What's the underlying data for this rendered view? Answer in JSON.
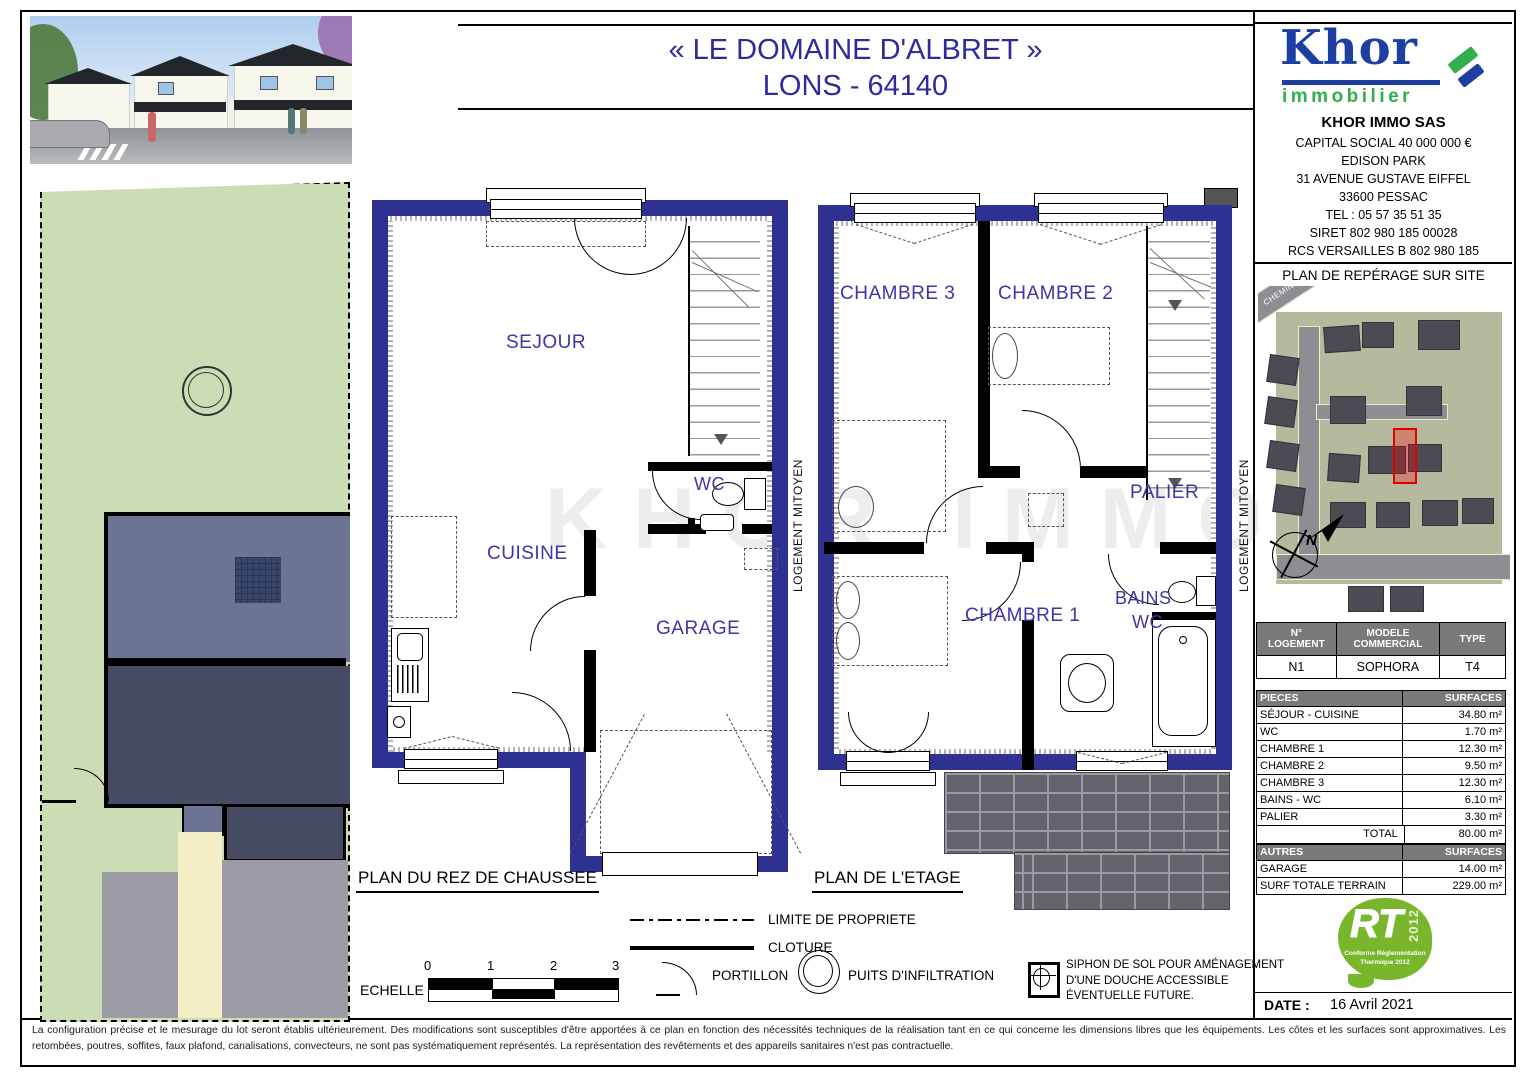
{
  "title": {
    "line1": "« LE DOMAINE D'ALBRET »",
    "line2": "LONS - 64140"
  },
  "logo": {
    "main": "Khor",
    "sub": "immobilier"
  },
  "company": {
    "name": "KHOR IMMO SAS",
    "line1": "CAPITAL SOCIAL 40 000 000 €",
    "line2": "EDISON PARK",
    "line3": "31 AVENUE GUSTAVE EIFFEL",
    "line4": "33600 PESSAC",
    "line5": "TEL : 05 57 35 51 35",
    "line6": "SIRET 802 980 185 00028",
    "line7": "RCS VERSAILLES B 802 980 185"
  },
  "site_map": {
    "title": "PLAN DE REPÉRAGE SUR SITE",
    "road_label": "CHEMIN DE LASGOURGES",
    "north_label": "N"
  },
  "plans": {
    "rdc_title": "PLAN DU REZ DE CHAUSSEE",
    "etage_title": "PLAN DE L'ETAGE",
    "party_wall": "LOGEMENT MITOYEN",
    "rooms": {
      "sejour": "SEJOUR",
      "wc": "WC",
      "cuisine": "CUISINE",
      "garage": "GARAGE",
      "ch3": "CHAMBRE 3",
      "ch2": "CHAMBRE 2",
      "palier": "PALIER",
      "ch1": "CHAMBRE 1",
      "bains1": "BAINS",
      "bains2": "WC"
    }
  },
  "legend": {
    "echelle": "ECHELLE :",
    "scale": {
      "0": "0",
      "1": "1",
      "2": "2",
      "3": "3"
    },
    "limite": "LIMITE DE PROPRIETE",
    "cloture": "CLOTURE",
    "portillon": "PORTILLON",
    "puits": "PUITS D'INFILTRATION",
    "siphon1": "SIPHON DE SOL POUR AMÉNAGEMENT",
    "siphon2": "D'UNE DOUCHE ACCESSIBLE",
    "siphon3": "ÉVENTUELLE  FUTURE."
  },
  "unit_table": {
    "h1a": "N°",
    "h1b": "LOGEMENT",
    "h2a": "MODELE",
    "h2b": "COMMERCIAL",
    "h3": "TYPE",
    "r1": "N1",
    "r2": "SOPHORA",
    "r3": "T4"
  },
  "pieces_table": {
    "h1": "PIECES",
    "h2": "SURFACES",
    "rows": [
      [
        "SÉJOUR - CUISINE",
        "34.80 m²"
      ],
      [
        "WC",
        "1.70 m²"
      ],
      [
        "CHAMBRE 1",
        "12.30 m²"
      ],
      [
        "CHAMBRE 2",
        "9.50 m²"
      ],
      [
        "CHAMBRE 3",
        "12.30 m²"
      ],
      [
        "BAINS - WC",
        "6.10 m²"
      ],
      [
        "PALIER",
        "3.30 m²"
      ]
    ],
    "total_label": "TOTAL",
    "total_value": "80.00 m²"
  },
  "autres_table": {
    "h1": "AUTRES",
    "h2": "SURFACES",
    "rows": [
      [
        "GARAGE",
        "14.00 m²"
      ],
      [
        "SURF TOTALE TERRAIN",
        "229.00 m²"
      ]
    ]
  },
  "rt_logo": {
    "main": "RT",
    "year": "2012",
    "sub1": "Conforme Réglementation",
    "sub2": "Thermique 2012"
  },
  "date": {
    "label": "DATE :",
    "value": "16 Avril 2021"
  },
  "watermark": "KHOR IMMO",
  "disclaimer": "La configuration précise et le mesurage du lot seront établis ultérieurement. Des modifications sont susceptibles d'être apportées à ce plan en fonction des nécessités techniques de la réalisation tant en ce qui concerne les dimensions libres que les équipements. Les côtes et les surfaces sont approximatives. Les retombées, poutres, soffites, faux plafond, canalisations, convecteurs, ne sont pas systématiquement représentés. La représentation des revêtements et des appareils sanitaires n'est pas contractuelle.",
  "colors": {
    "wall_navy": "#2e3192",
    "label_purple": "#3d36a8",
    "table_header_grey": "#7a7a7a",
    "rt_green": "#79b62c",
    "logo_blue": "#1d3fa2",
    "logo_green": "#2fb04a",
    "lot_red": "#e00000",
    "garden_green": "#ccdcb4"
  }
}
